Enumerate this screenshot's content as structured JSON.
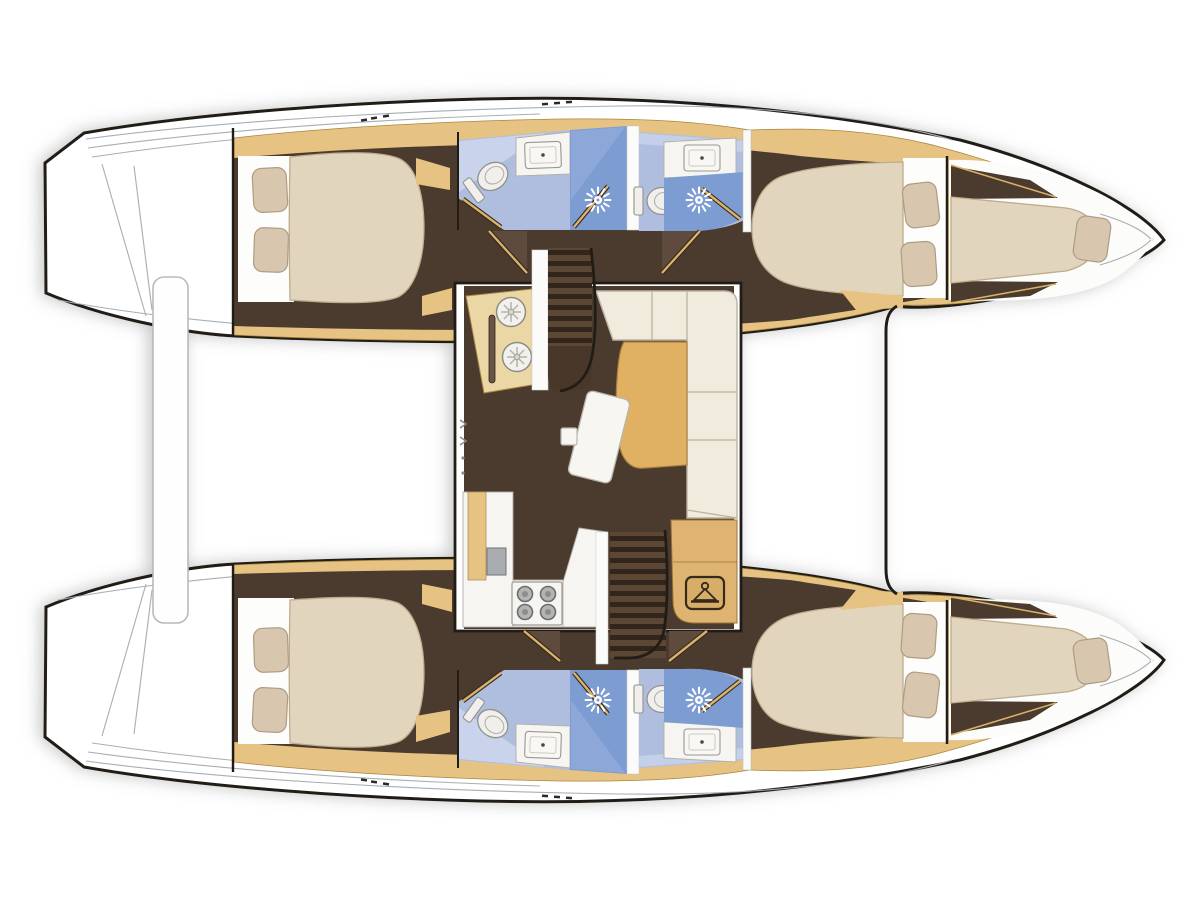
{
  "meta": {
    "title": "Catamaran interior floor plan (top view)",
    "orientation": "bows pointing right, sterns with transom steps at left",
    "drawing_style": "color technical layout illustration, no text labels"
  },
  "palette": {
    "outline": "#241e18",
    "hull_white": "#ffffff",
    "deck_line": "#a9aeb3",
    "wood": "#e7c383",
    "wood_edge": "#a8863f",
    "counter_wood": "#ebd6a6",
    "walnut": "#4b3a2e",
    "walnut_light": "#5f4b3c",
    "mattress": "#e2d5bd",
    "mattress_edge": "#bfab8d",
    "pillow": "#d8c6ae",
    "pillow_edge": "#ad9c83",
    "linen": "#fdfdfb",
    "bath_floor": "#afbedf",
    "bath_floor_light": "#c9d3ec",
    "shower_blue": "#7b9cd2",
    "fixture": "#f1efeb",
    "fixture_edge": "#93918c",
    "counter": "#f7f5f1",
    "counter_edge": "#b3afa7",
    "appliance": "#a9adb2",
    "burner": "#b4b4b4",
    "table_wood": "#e0b163",
    "table_edge": "#aa8040",
    "sofa": "#f1ebde",
    "sofa_seam": "#bcb3a1",
    "stair_wood": "#5b4735",
    "stair_groove": "#33281e",
    "door_leaf": "#d9b26c",
    "shadow": "#8a8a8a"
  },
  "vessel": {
    "type": "sailing catamaran, 4-cabin / 4-head layout",
    "hulls": [
      {
        "name": "upper hull",
        "compartments": [
          "transom steps and aft deck",
          "aft double-berth cabin with two pillows",
          "aft head: toilet, washbasin, separate shower with sunburst rose",
          "forward head: toilet, washbasin, separate shower with sunburst rose",
          "forward double-berth cabin with two pillows",
          "bow berth (forepeak) with single pillow"
        ]
      },
      {
        "name": "lower hull",
        "compartments": [
          "transom steps and aft deck",
          "aft double-berth cabin with two pillows",
          "aft head: toilet, washbasin, separate shower with sunburst rose",
          "forward head: toilet, washbasin, separate shower with sunburst rose",
          "forward double-berth cabin with two pillows",
          "bow berth (forepeak) with single pillow"
        ]
      }
    ],
    "bridgedeck_salon": {
      "features": [
        "galley counter with twin round sinks and rail (upper-left)",
        "companionway stairs to upper hull",
        "L-shaped settee of cream cushions (right side)",
        "wooden dining table",
        "tilted white folding table leaf and small stool",
        "galley counter with fridge and 4-burner stove (lower-left)",
        "companionway stairs to lower hull",
        "chaise bench with wardrobe locker (hanger symbol)"
      ]
    },
    "between_hulls": [
      "aft crossbeam / gangway plank (white rounded bar, left)",
      "bridgedeck front bulkhead line (vertical, right of salon)"
    ],
    "icons": {
      "shower": "white sunburst spray rose",
      "wardrobe": "clothes-hanger glyph in rounded box",
      "stove": "four grey round burners",
      "galley_sink": "two round basins with spoke pattern",
      "bathroom_sink": "rounded rectangle basin with drain dot",
      "toilet": "oval bowl with cistern bar",
      "stairs": "dark laddered treads",
      "door_swing": "quarter-swing wedge with wood leaf line"
    }
  }
}
